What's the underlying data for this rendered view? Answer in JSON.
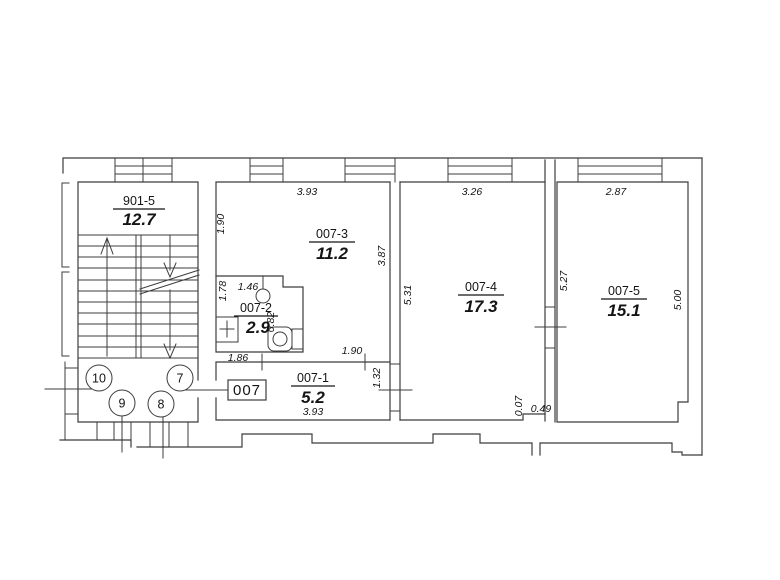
{
  "stairwell": {
    "code": "901-5",
    "area": "12.7",
    "markers": [
      "10",
      "7",
      "9",
      "8"
    ]
  },
  "unit_box_label": "007",
  "rooms": {
    "r1": {
      "code": "007-1",
      "area": "5.2"
    },
    "r2": {
      "code": "007-2",
      "area": "2.9"
    },
    "r3": {
      "code": "007-3",
      "area": "11.2"
    },
    "r4": {
      "code": "007-4",
      "area": "17.3"
    },
    "r5": {
      "code": "007-5",
      "area": "15.1"
    }
  },
  "dims": {
    "r3_top": "3.93",
    "r3_left": "1.90",
    "r3_right": "3.87",
    "r4_top": "3.26",
    "r4_left": "5.31",
    "r4_right": "5.27",
    "r5_top": "2.87",
    "r5_right": "5.00",
    "r2_left": "1.78",
    "r2_top": "1.46",
    "r2_mid": "0.82",
    "r2_bottom": "1.86",
    "r1_opening": "1.90",
    "r1_bottom": "3.93",
    "r1_door": "1.32",
    "r4_step_h": "0.07",
    "r4_step_w": "0.49"
  },
  "colors": {
    "line": "#3c3c3c",
    "text": "#141414",
    "bg": "#ffffff"
  }
}
